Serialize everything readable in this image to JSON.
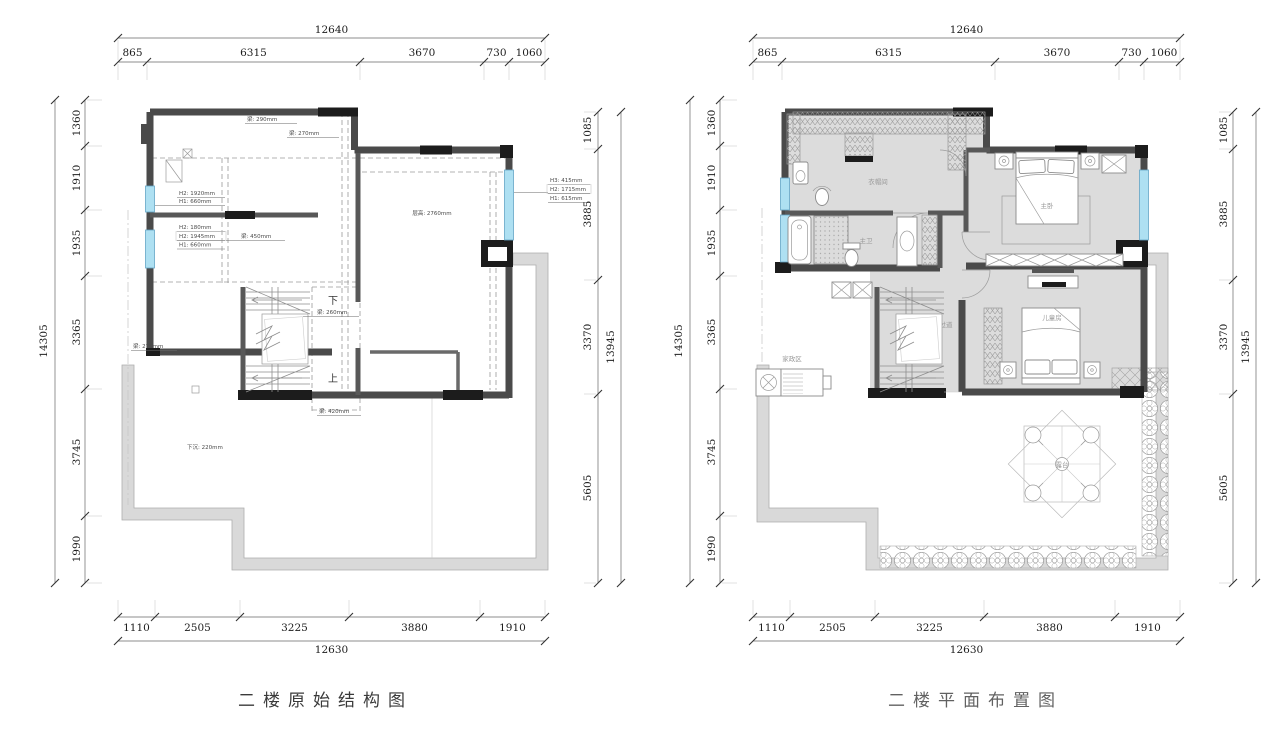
{
  "captions": {
    "left": "二楼原始结构图",
    "right": "二楼平面布置图"
  },
  "dims": {
    "top_total": "12640",
    "top_segments": [
      "865",
      "6315",
      "3670",
      "730",
      "1060"
    ],
    "bottom_total": "12630",
    "bottom_segments": [
      "1110",
      "2505",
      "3225",
      "3880",
      "1910"
    ],
    "left_total": "14305",
    "left_segments": [
      "1360",
      "1910",
      "1935",
      "3365",
      "3745",
      "1990"
    ],
    "right_total": "13945",
    "right_segments": [
      "1085",
      "3885",
      "3370",
      "5605"
    ]
  },
  "left_plan": {
    "annotations": {
      "beam_290": "梁: 290mm",
      "beam_270_top": "梁: 270mm",
      "window_left1_line1": "H2: 1920mm",
      "window_left1_line2": "H1: 660mm",
      "window_left2_line1": "H2: 180mm",
      "window_left2_line2": "H2: 1945mm",
      "window_left2_line3": "H1: 660mm",
      "beam_450": "梁: 450mm",
      "ceiling_height": "层高: 2760mm",
      "window_right_line1": "H3: 415mm",
      "window_right_line2": "H2: 1715mm",
      "window_right_line3": "H1: 615mm",
      "beam_260": "梁: 260mm",
      "beam_420": "梁: 420mm",
      "beam_270_left": "梁: 270mm",
      "sunken": "下沉: 220mm",
      "stair_down": "下",
      "stair_up": "上"
    }
  },
  "right_plan": {
    "rooms": {
      "cloakroom": "衣帽间",
      "master_bath": "主卫",
      "master_bedroom": "主卧",
      "corridor": "过道",
      "kids_room": "儿童房",
      "laundry": "家政区",
      "terrace": "露台"
    }
  },
  "colors": {
    "wall": "#4a4a4a",
    "window": "#aee0f2",
    "terrace_band": "#d9d9d9",
    "room_fill": "#dcdcdc"
  }
}
